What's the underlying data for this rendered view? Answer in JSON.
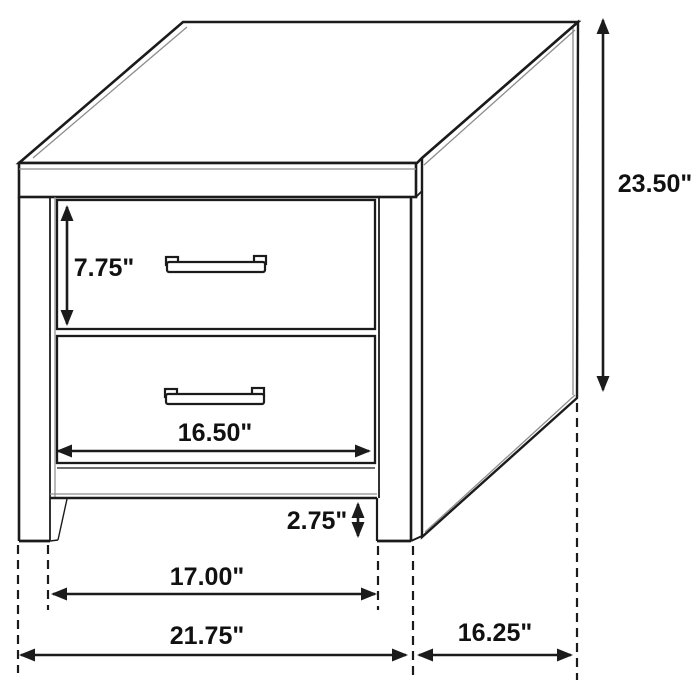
{
  "diagram": {
    "depicted_object": "two-drawer nightstand dimension drawing",
    "canvas": {
      "width": 700,
      "height": 700,
      "background": "#ffffff"
    },
    "style": {
      "line_color": "#1b1b1b",
      "detail_line_color": "#8d8d8d",
      "label_color": "#111111",
      "label_font_size": 25,
      "dimension_line_width": 2.6,
      "extension_line_width": 2.2,
      "arrow_length": 16,
      "arrow_half_width": 6.5,
      "dash_pattern": "9 6"
    },
    "dimensions": [
      {
        "id": "overall-height",
        "label": "23.50\"",
        "orientation": "vertical",
        "x": 603,
        "from": 18,
        "to": 392,
        "label_x": 655,
        "label_y": 184
      },
      {
        "id": "top-drawer-height",
        "label": "7.75\"",
        "orientation": "vertical",
        "x": 67,
        "from": 205,
        "to": 326,
        "label_x": 104,
        "label_y": 268
      },
      {
        "id": "drawer-width",
        "label": "16.50\"",
        "orientation": "horizontal",
        "y": 451,
        "from": 56,
        "to": 371,
        "label_x": 215,
        "label_y": 433
      },
      {
        "id": "base-height",
        "label": "2.75\"",
        "orientation": "vertical",
        "x": 358,
        "from": 502,
        "to": 538,
        "label_x": 317,
        "label_y": 521
      },
      {
        "id": "leg-span",
        "label": "17.00\"",
        "orientation": "horizontal",
        "y": 594,
        "from": 51,
        "to": 377,
        "label_x": 207,
        "label_y": 577
      },
      {
        "id": "overall-width",
        "label": "21.75\"",
        "orientation": "horizontal",
        "y": 655,
        "from": 19,
        "to": 408,
        "label_x": 207,
        "label_y": 636
      },
      {
        "id": "depth",
        "label": "16.25\"",
        "orientation": "horizontal",
        "y": 655,
        "from": 417,
        "to": 573,
        "label_x": 495,
        "label_y": 633
      }
    ],
    "extension_lines": [
      {
        "id": "left-outer",
        "x": 18,
        "from": 545,
        "to": 673
      },
      {
        "id": "left-inner",
        "x": 48,
        "from": 545,
        "to": 610
      },
      {
        "id": "right-inner",
        "x": 378,
        "from": 546,
        "to": 610
      },
      {
        "id": "right-outer",
        "x": 413,
        "from": 546,
        "to": 680
      },
      {
        "id": "back-edge",
        "x": 577,
        "from": 403,
        "to": 680
      }
    ]
  }
}
